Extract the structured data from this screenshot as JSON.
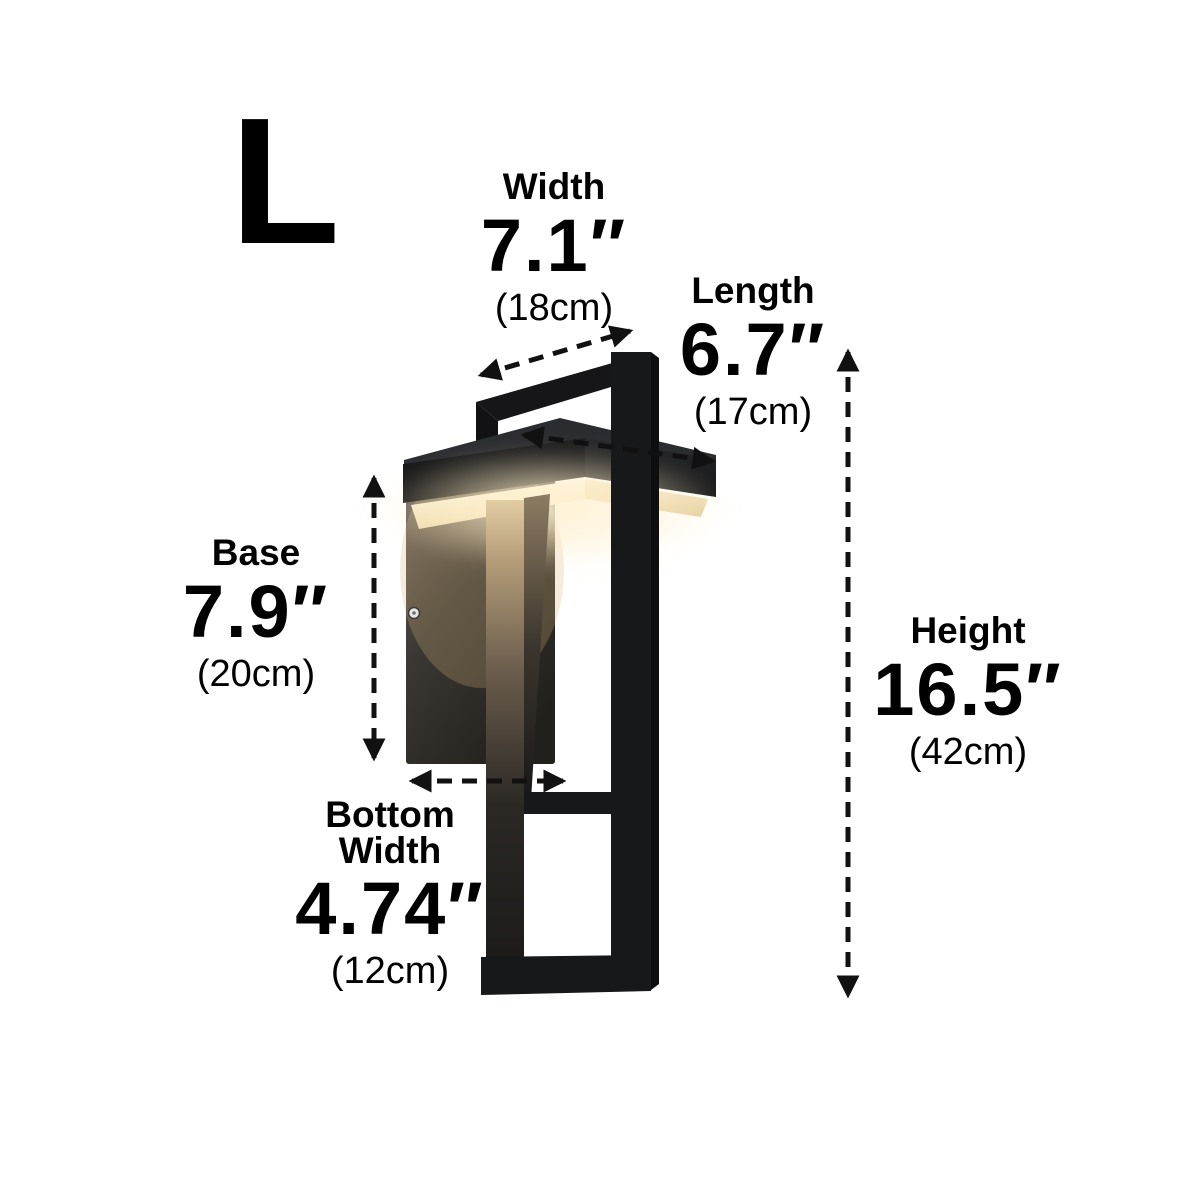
{
  "size_badge": {
    "letter": "L"
  },
  "dimensions": {
    "width": {
      "label": "Width",
      "inches": "7.1″",
      "cm": "(18cm)"
    },
    "length": {
      "label": "Length",
      "inches": "6.7″",
      "cm": "(17cm)"
    },
    "base": {
      "label": "Base",
      "inches": "7.9″",
      "cm": "(20cm)"
    },
    "bottom_width": {
      "label_line1": "Bottom",
      "label_line2": "Width",
      "inches": "4.74″",
      "cm": "(12cm)"
    },
    "height": {
      "label": "Height",
      "inches": "16.5″",
      "cm": "(42cm)"
    }
  },
  "illustration": {
    "subject": "black rectangular LED outdoor wall sconce, lit warm white",
    "colors": {
      "frame_black": "#161618",
      "glow_warm": "#f6e2b1",
      "backplate_gray": "#4a453e",
      "annotation_black": "#111111",
      "background": "#ffffff"
    }
  }
}
